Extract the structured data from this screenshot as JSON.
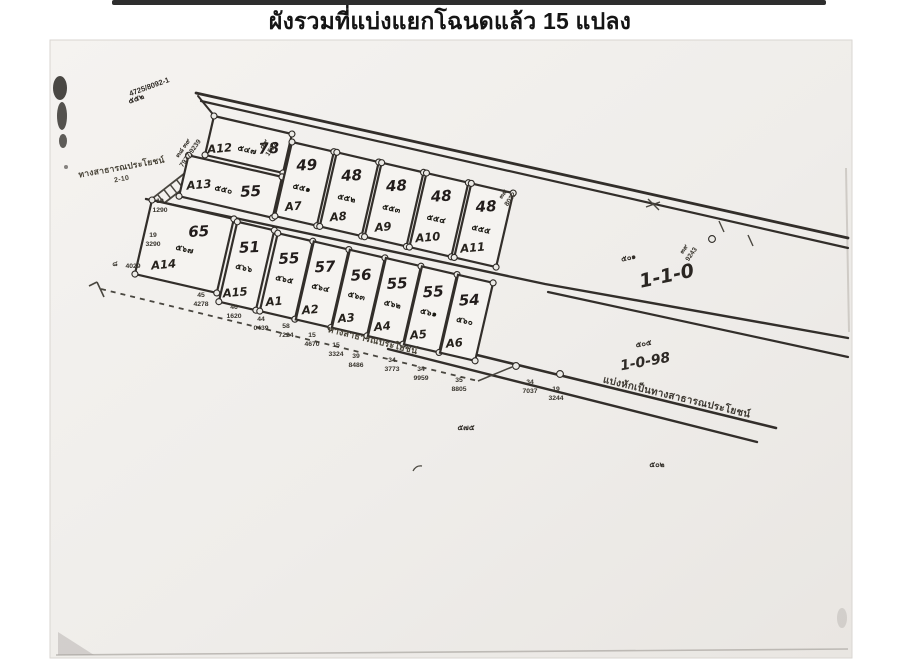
{
  "title": "ผังรวมที่แบ่งแยกโฉนดแล้ว 15 แปลง",
  "map": {
    "road_labels": {
      "west_road": "ทางสาธารณประโยชน์",
      "west_road_width": "2-10",
      "south_road": "ทางสาธารณประโยชน์",
      "split_road": "แบ่งหักเป็นทางสาธารณประโยชน์"
    },
    "parcel_refs": {
      "boundary_ref": "4725/8092-1",
      "boundary_ref_no": "๕๕๒",
      "area_note_center": "1-1-0",
      "area_note_center_no": "๕๐๑",
      "area_note_south": "1-0-98",
      "area_note_south_no": "๕๐๕",
      "small_ref_1": "๕๗๕",
      "small_ref_2": "๕๐๒"
    },
    "plots": [
      {
        "id": "A12",
        "size": "78",
        "deed": "๕๔๗"
      },
      {
        "id": "A13",
        "size": "55",
        "deed": "๕๕๐"
      },
      {
        "id": "A7",
        "size": "49",
        "deed": "๕๕๑"
      },
      {
        "id": "A8",
        "size": "48",
        "deed": "๕๕๒"
      },
      {
        "id": "A9",
        "size": "48",
        "deed": "๕๕๓"
      },
      {
        "id": "A10",
        "size": "48",
        "deed": "๕๕๔"
      },
      {
        "id": "A11",
        "size": "48",
        "deed": "๕๕๕"
      },
      {
        "id": "A14",
        "size": "65",
        "deed": "๕๖๗"
      },
      {
        "id": "A15",
        "size": "51",
        "deed": "๕๖๖"
      },
      {
        "id": "A1",
        "size": "55",
        "deed": "๕๖๕"
      },
      {
        "id": "A2",
        "size": "57",
        "deed": "๕๖๔"
      },
      {
        "id": "A3",
        "size": "56",
        "deed": "๕๖๓"
      },
      {
        "id": "A4",
        "size": "55",
        "deed": "๕๖๒"
      },
      {
        "id": "A5",
        "size": "55",
        "deed": "๕๖๑"
      },
      {
        "id": "A6",
        "size": "54",
        "deed": "๕๖๐"
      }
    ],
    "survey_markers": [
      {
        "no": "๓๘ ๓๙",
        "id": "7977,9239"
      },
      {
        "no": "๔๙",
        "id": "1537"
      },
      {
        "no": "๓๙",
        "id": "8032"
      },
      {
        "no": "๓๙",
        "id": "9243"
      },
      {
        "no": "19",
        "id": "3290"
      },
      {
        "no": "๘",
        "id": "4029"
      },
      {
        "no": "19",
        "id": "1290"
      },
      {
        "no": "45",
        "id": "4278"
      },
      {
        "no": "46",
        "id": "1620"
      },
      {
        "no": "44",
        "id": "0439"
      },
      {
        "no": "58",
        "id": "7224"
      },
      {
        "no": "15",
        "id": "4670"
      },
      {
        "no": "15",
        "id": "3324"
      },
      {
        "no": "39",
        "id": "8486"
      },
      {
        "no": "34",
        "id": "3773"
      },
      {
        "no": "34",
        "id": "9959"
      },
      {
        "no": "35",
        "id": "8805"
      },
      {
        "no": "34",
        "id": "7037"
      },
      {
        "no": "19",
        "id": "3244"
      }
    ]
  }
}
